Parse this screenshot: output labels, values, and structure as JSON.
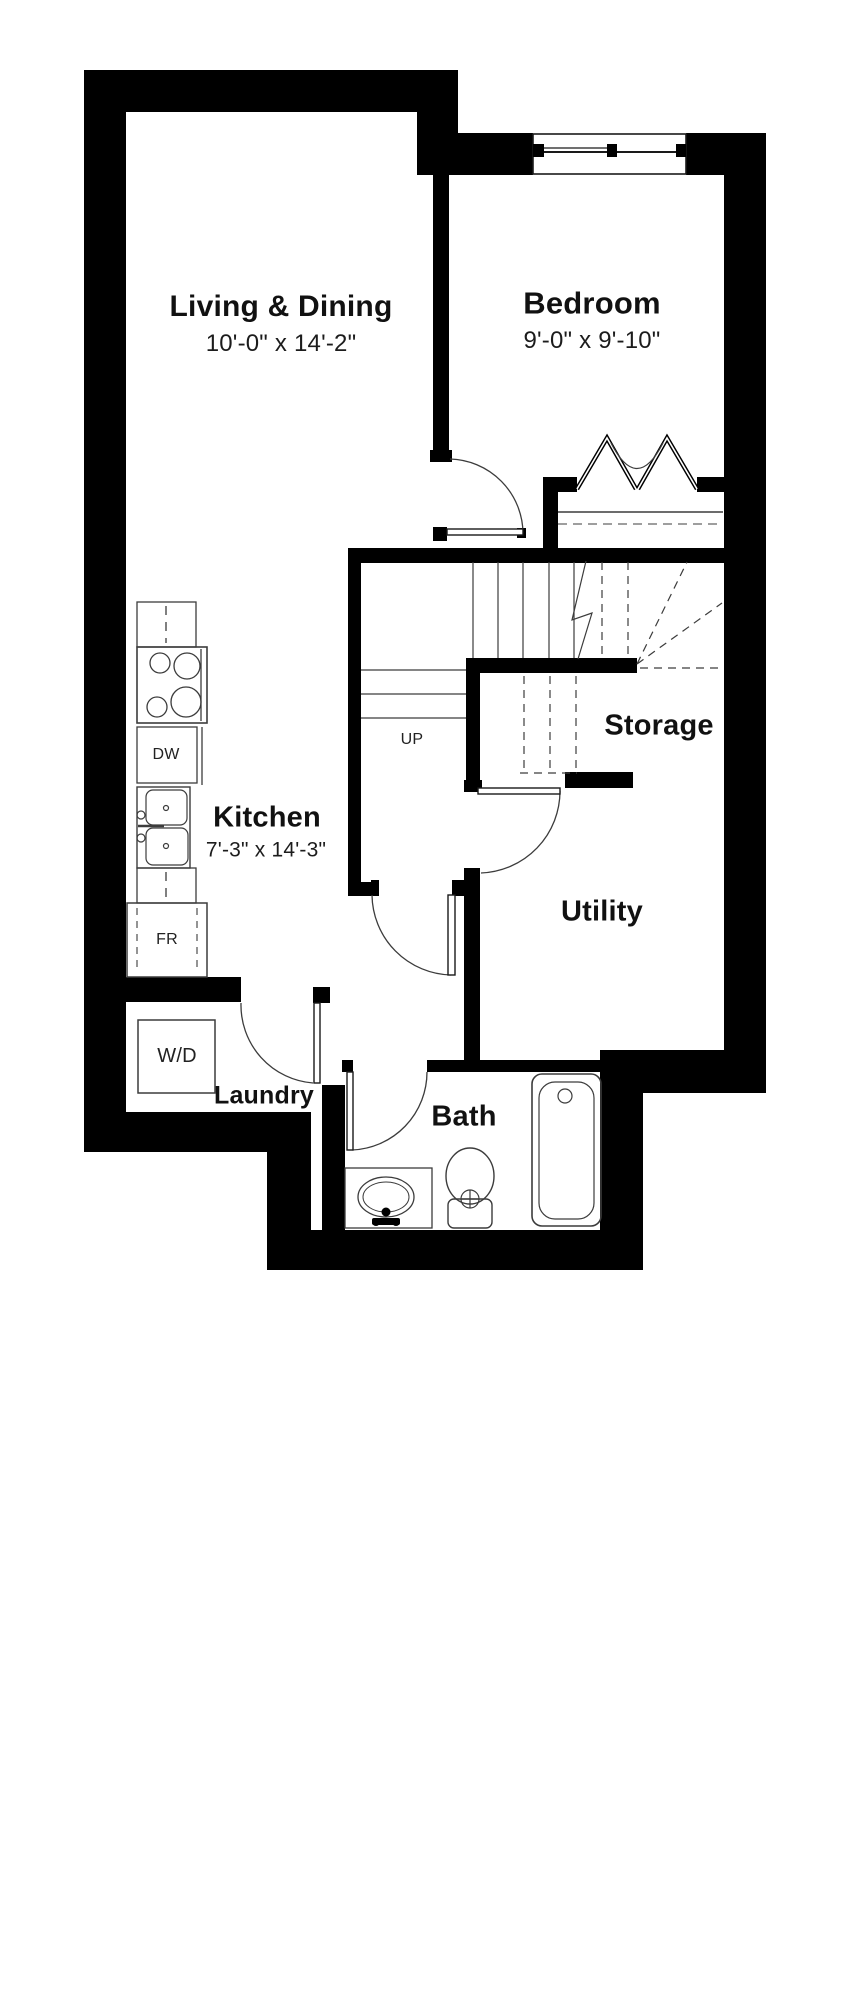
{
  "title": "Unit Floor Plan",
  "colors": {
    "wall": "#000000",
    "line": "#3c3c3c",
    "text": "#111111",
    "bg": "#ffffff"
  },
  "rooms": {
    "living": {
      "name": "Living & Dining",
      "dims": "10'-0\" x 14'-2\""
    },
    "bedroom": {
      "name": "Bedroom",
      "dims": "9'-0\" x 9'-10\""
    },
    "kitchen": {
      "name": "Kitchen",
      "dims": "7'-3\" x 14'-3\""
    },
    "storage": {
      "name": "Storage"
    },
    "utility": {
      "name": "Utility"
    },
    "bath": {
      "name": "Bath"
    },
    "laundry": {
      "name": "Laundry"
    }
  },
  "annotations": {
    "stairs_up": "UP"
  },
  "appliances": {
    "dishwasher": "DW",
    "fridge": "FR",
    "washer_dryer": "W/D"
  }
}
